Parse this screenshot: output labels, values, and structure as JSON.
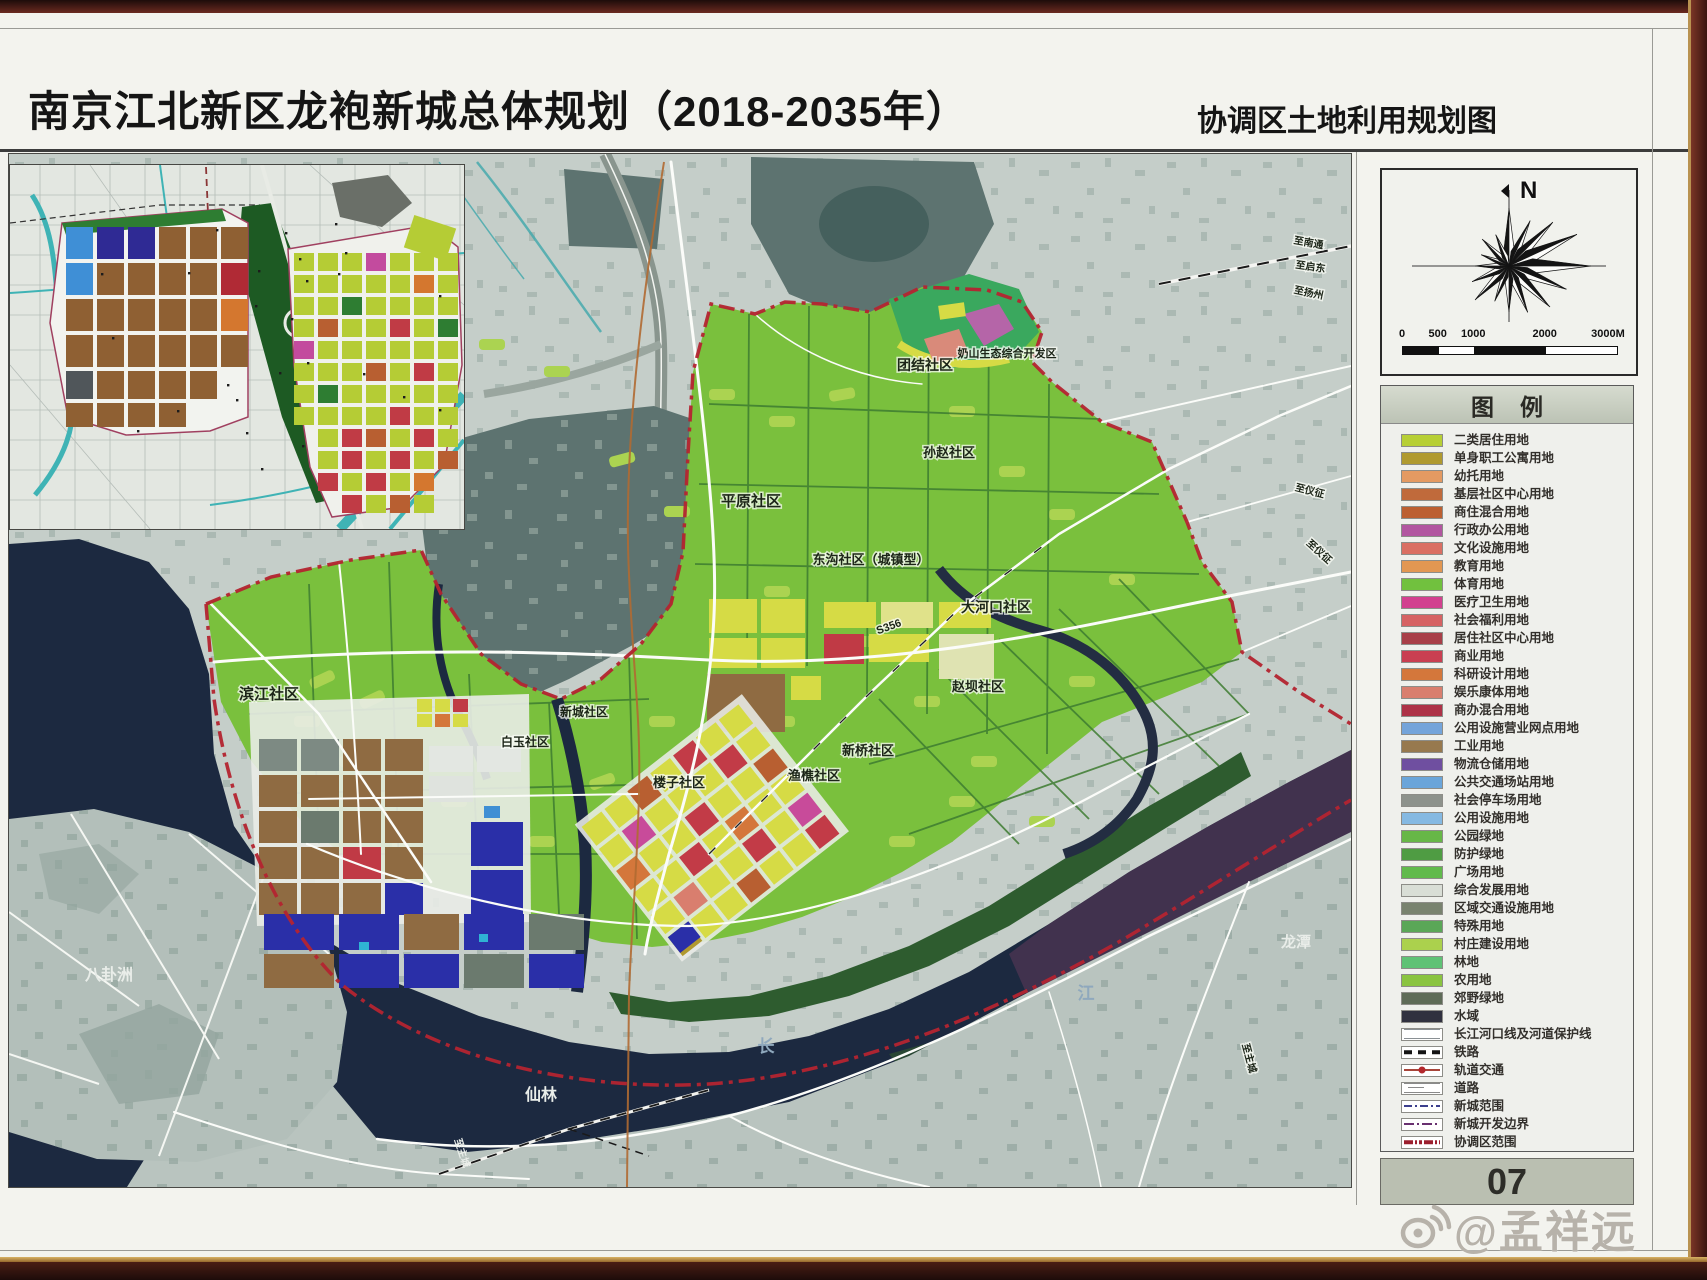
{
  "header": {
    "title": "南京江北新区龙袍新城总体规划（2018-2035年）",
    "subtitle": "协调区土地利用规划图"
  },
  "compass": {
    "north": "N"
  },
  "scale_bar": {
    "ticks": [
      "0",
      "500",
      "1000",
      "2000",
      "3000M"
    ]
  },
  "legend": {
    "header": "图例",
    "items": [
      {
        "label": "二类居住用地",
        "color": "#b7cf35"
      },
      {
        "label": "单身职工公寓用地",
        "color": "#b09a2f"
      },
      {
        "label": "幼托用地",
        "color": "#e49a62"
      },
      {
        "label": "基层社区中心用地",
        "color": "#c06a3b"
      },
      {
        "label": "商住混合用地",
        "color": "#bc5f31"
      },
      {
        "label": "行政办公用地",
        "color": "#b256a0"
      },
      {
        "label": "文化设施用地",
        "color": "#da6f63"
      },
      {
        "label": "教育用地",
        "color": "#e29752"
      },
      {
        "label": "体育用地",
        "color": "#71c13e"
      },
      {
        "label": "医疗卫生用地",
        "color": "#d2408f"
      },
      {
        "label": "社会福利用地",
        "color": "#d66263"
      },
      {
        "label": "居住社区中心用地",
        "color": "#a83f48"
      },
      {
        "label": "商业用地",
        "color": "#c93f51"
      },
      {
        "label": "科研设计用地",
        "color": "#d4773b"
      },
      {
        "label": "娱乐康体用地",
        "color": "#d97e6e"
      },
      {
        "label": "商办混合用地",
        "color": "#ad3247"
      },
      {
        "label": "公用设施营业网点用地",
        "color": "#74a4da"
      },
      {
        "label": "工业用地",
        "color": "#97794e"
      },
      {
        "label": "物流仓储用地",
        "color": "#6f4fa0"
      },
      {
        "label": "公共交通场站用地",
        "color": "#6aa5da"
      },
      {
        "label": "社会停车场用地",
        "color": "#8d928c"
      },
      {
        "label": "公用设施用地",
        "color": "#85b9e2"
      },
      {
        "label": "公园绿地",
        "color": "#67b747"
      },
      {
        "label": "防护绿地",
        "color": "#4f9c43"
      },
      {
        "label": "广场用地",
        "color": "#61ba4c"
      },
      {
        "label": "综合发展用地",
        "color": "#d9ded6"
      },
      {
        "label": "区域交通设施用地",
        "color": "#79836f"
      },
      {
        "label": "特殊用地",
        "color": "#5aa757"
      },
      {
        "label": "村庄建设用地",
        "color": "#abd14d"
      },
      {
        "label": "林地",
        "color": "#5fc275"
      },
      {
        "label": "农用地",
        "color": "#8ac440"
      },
      {
        "label": "郊野绿地",
        "color": "#5e6b57"
      },
      {
        "label": "水域",
        "color": "#30313f"
      },
      {
        "label": "长江河口线及河道保护线",
        "line": "estuary"
      },
      {
        "label": "铁路",
        "line": "rail"
      },
      {
        "label": "轨道交通",
        "line": "metro"
      },
      {
        "label": "道路",
        "line": "road"
      },
      {
        "label": "新城范围",
        "line": "newtown"
      },
      {
        "label": "新城开发边界",
        "line": "devedge"
      },
      {
        "label": "协调区范围",
        "line": "coord"
      }
    ]
  },
  "page_number": "07",
  "watermark": {
    "text": "@孟祥远",
    "icon": "weibo-icon"
  },
  "map": {
    "labels": [
      {
        "text": "滨江社区",
        "x": 260,
        "y": 545,
        "size": 15
      },
      {
        "text": "平原社区",
        "x": 742,
        "y": 352,
        "size": 15
      },
      {
        "text": "东沟社区（城镇型）",
        "x": 862,
        "y": 410,
        "size": 13
      },
      {
        "text": "团结社区",
        "x": 916,
        "y": 216,
        "size": 14
      },
      {
        "text": "奶山生态综合开发区",
        "x": 998,
        "y": 203,
        "size": 11
      },
      {
        "text": "孙赵社区",
        "x": 940,
        "y": 303,
        "size": 13
      },
      {
        "text": "大河口社区",
        "x": 987,
        "y": 458,
        "size": 14
      },
      {
        "text": "赵坝社区",
        "x": 969,
        "y": 537,
        "size": 13
      },
      {
        "text": "新桥社区",
        "x": 859,
        "y": 601,
        "size": 13
      },
      {
        "text": "渔樵社区",
        "x": 805,
        "y": 626,
        "size": 13
      },
      {
        "text": "楼子社区",
        "x": 670,
        "y": 633,
        "size": 13
      },
      {
        "text": "新城社区",
        "x": 575,
        "y": 562,
        "size": 12
      },
      {
        "text": "白玉社区",
        "x": 516,
        "y": 592,
        "size": 12
      },
      {
        "text": "S356",
        "x": 881,
        "y": 476,
        "size": 11,
        "rotate": -20
      },
      {
        "text": "八卦洲",
        "x": 100,
        "y": 826,
        "size": 16,
        "color": "#e9ede9",
        "halo": "none"
      },
      {
        "text": "仙林",
        "x": 532,
        "y": 946,
        "size": 16,
        "color": "#e9ede9",
        "halo": "none"
      },
      {
        "text": "长",
        "x": 757,
        "y": 898,
        "size": 17,
        "color": "#8fa8bd",
        "halo": "none"
      },
      {
        "text": "江",
        "x": 1077,
        "y": 845,
        "size": 17,
        "color": "#8fa8bd",
        "halo": "none"
      },
      {
        "text": "龙潭",
        "x": 1287,
        "y": 793,
        "size": 15,
        "color": "#e9ede9",
        "halo": "none"
      },
      {
        "text": "至南通",
        "x": 1299,
        "y": 92,
        "size": 10,
        "rotate": 10
      },
      {
        "text": "至启东",
        "x": 1301,
        "y": 116,
        "size": 10,
        "rotate": 8
      },
      {
        "text": "至扬州",
        "x": 1299,
        "y": 142,
        "size": 10,
        "rotate": 12
      },
      {
        "text": "至仪征",
        "x": 1300,
        "y": 340,
        "size": 10,
        "rotate": 14
      },
      {
        "text": "至仪征",
        "x": 1308,
        "y": 400,
        "size": 10,
        "rotate": 42
      },
      {
        "text": "至主城",
        "x": 450,
        "y": 1000,
        "size": 10,
        "rotate": 72,
        "color": "#e9ede9",
        "halo": "none"
      },
      {
        "text": "至主城",
        "x": 1237,
        "y": 905,
        "size": 10,
        "rotate": 75
      }
    ]
  }
}
